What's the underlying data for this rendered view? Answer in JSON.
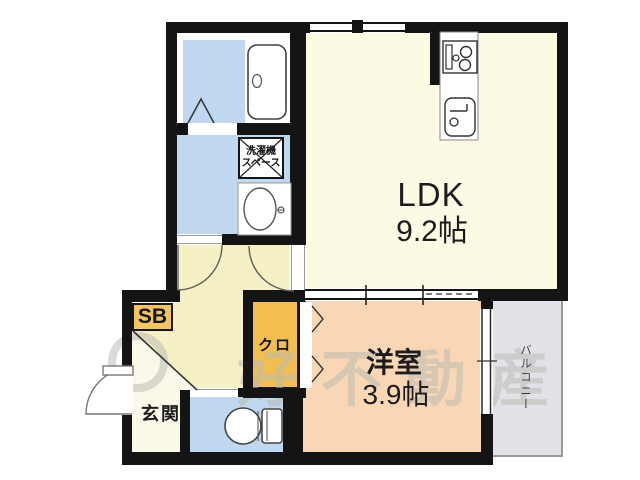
{
  "rooms": {
    "ldk": {
      "label": "LDK",
      "size": "9.2帖"
    },
    "western_room": {
      "label": "洋室",
      "size": "3.9帖"
    },
    "entrance": {
      "label": "玄関"
    },
    "closet": {
      "label": "クロ"
    },
    "shoe_box": {
      "label": "SB"
    },
    "balcony": {
      "label": "バルコニー"
    },
    "laundry_space": {
      "line1": "洗濯機",
      "line2": "スペース"
    }
  },
  "watermark": {
    "text": "好不動産"
  },
  "colors": {
    "wall": "#141414",
    "water_blue": "#BFD8F0",
    "ldk_cream": "#FCFAE3",
    "hall_yellow": "#F6F1C4",
    "entrance_cream": "#FAF8E9",
    "closet_orange": "#F2BE4F",
    "shoe_box_orange": "#F4C55E",
    "western_peach": "#F9D7B5",
    "balcony_gray": "#E3E0E8",
    "watermark_gray": "#BDBCB4"
  }
}
